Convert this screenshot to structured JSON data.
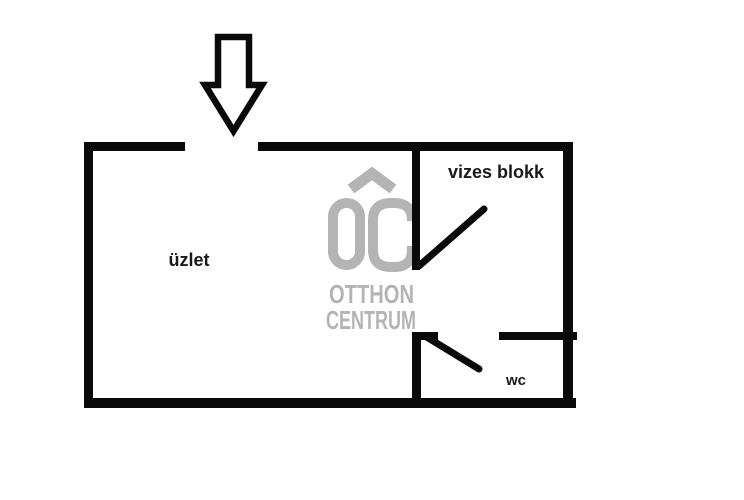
{
  "floor_plan": {
    "rooms": {
      "uzlet": "üzlet",
      "vizes_blokk": "vizes blokk",
      "wc": "wc"
    }
  },
  "watermark": {
    "line1": "OTTHON",
    "line2": "CENTRUM"
  },
  "colors": {
    "wall": "#0a0a0a",
    "text": "#1a1a1a",
    "watermark": "#b4b4b4",
    "background": "#ffffff"
  }
}
